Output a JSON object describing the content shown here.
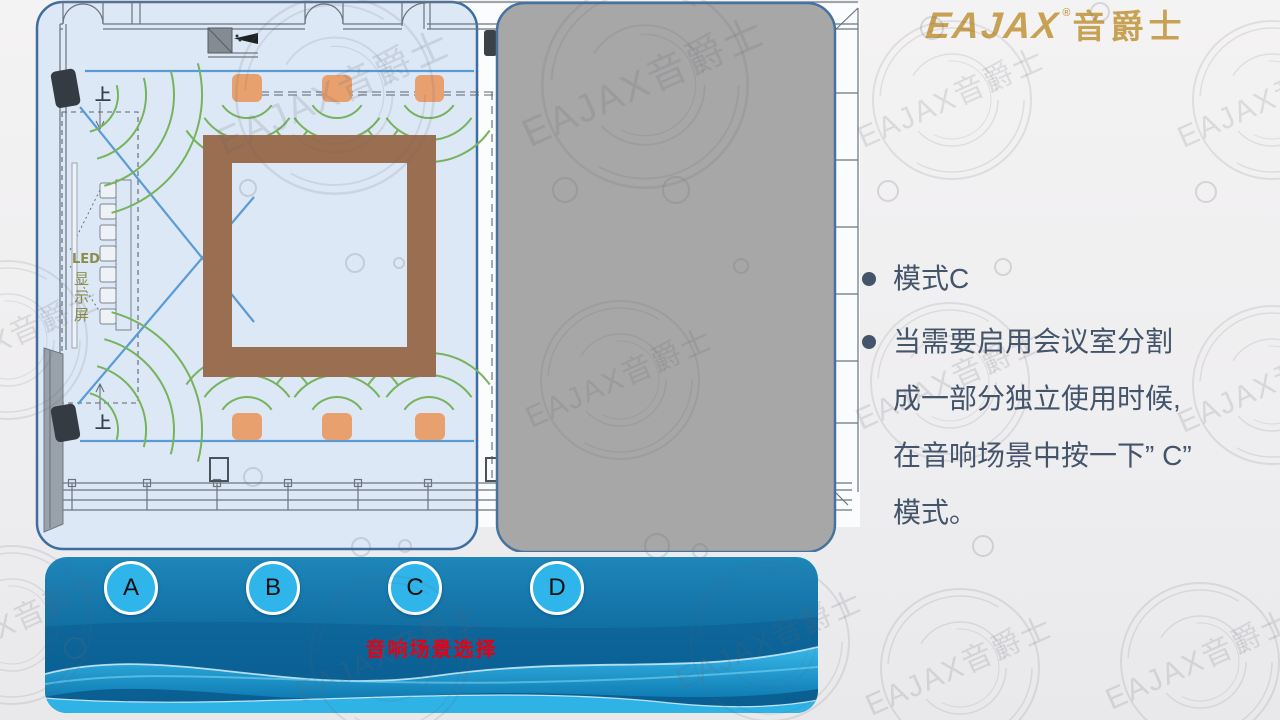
{
  "slide": {
    "title": "模式C",
    "logo": {
      "brand": "EAJAX",
      "registered_mark": "®",
      "brand_cn": "音爵士"
    },
    "watermark_text": "EAJAX音爵士",
    "floor_plan": {
      "up_label_top": "上",
      "up_label_bottom": "上",
      "led_label_line": "LED",
      "led_char_1": "显",
      "led_char_2": "示",
      "led_char_3": "屏"
    },
    "bullets": [
      {
        "text": "模式C"
      },
      {
        "lines": [
          "当需要启用会议室分割",
          "成一部分独立使用时候,",
          "在音响场景中按一下” C”",
          "模式。"
        ]
      }
    ],
    "scene_panel": {
      "title": "音响场景选择",
      "buttons": [
        {
          "label": "A"
        },
        {
          "label": "B"
        },
        {
          "label": "C"
        },
        {
          "label": "D"
        }
      ]
    },
    "colors": {
      "brand_gold": "#C8A254",
      "bullet_text": "#44546A",
      "scene_title_red": "#E60012",
      "button_blue": "#2FB5EA",
      "banner_blue_dark": "#0D6396",
      "plan_bg": "#DCE8F5",
      "overlay_gray": "#A7A7A7",
      "table_brown": "#9A6E50",
      "speaker_orange": "#E7A06E",
      "coverage_green": "#76B35C",
      "guide_line_blue": "#5B9BD5"
    }
  }
}
